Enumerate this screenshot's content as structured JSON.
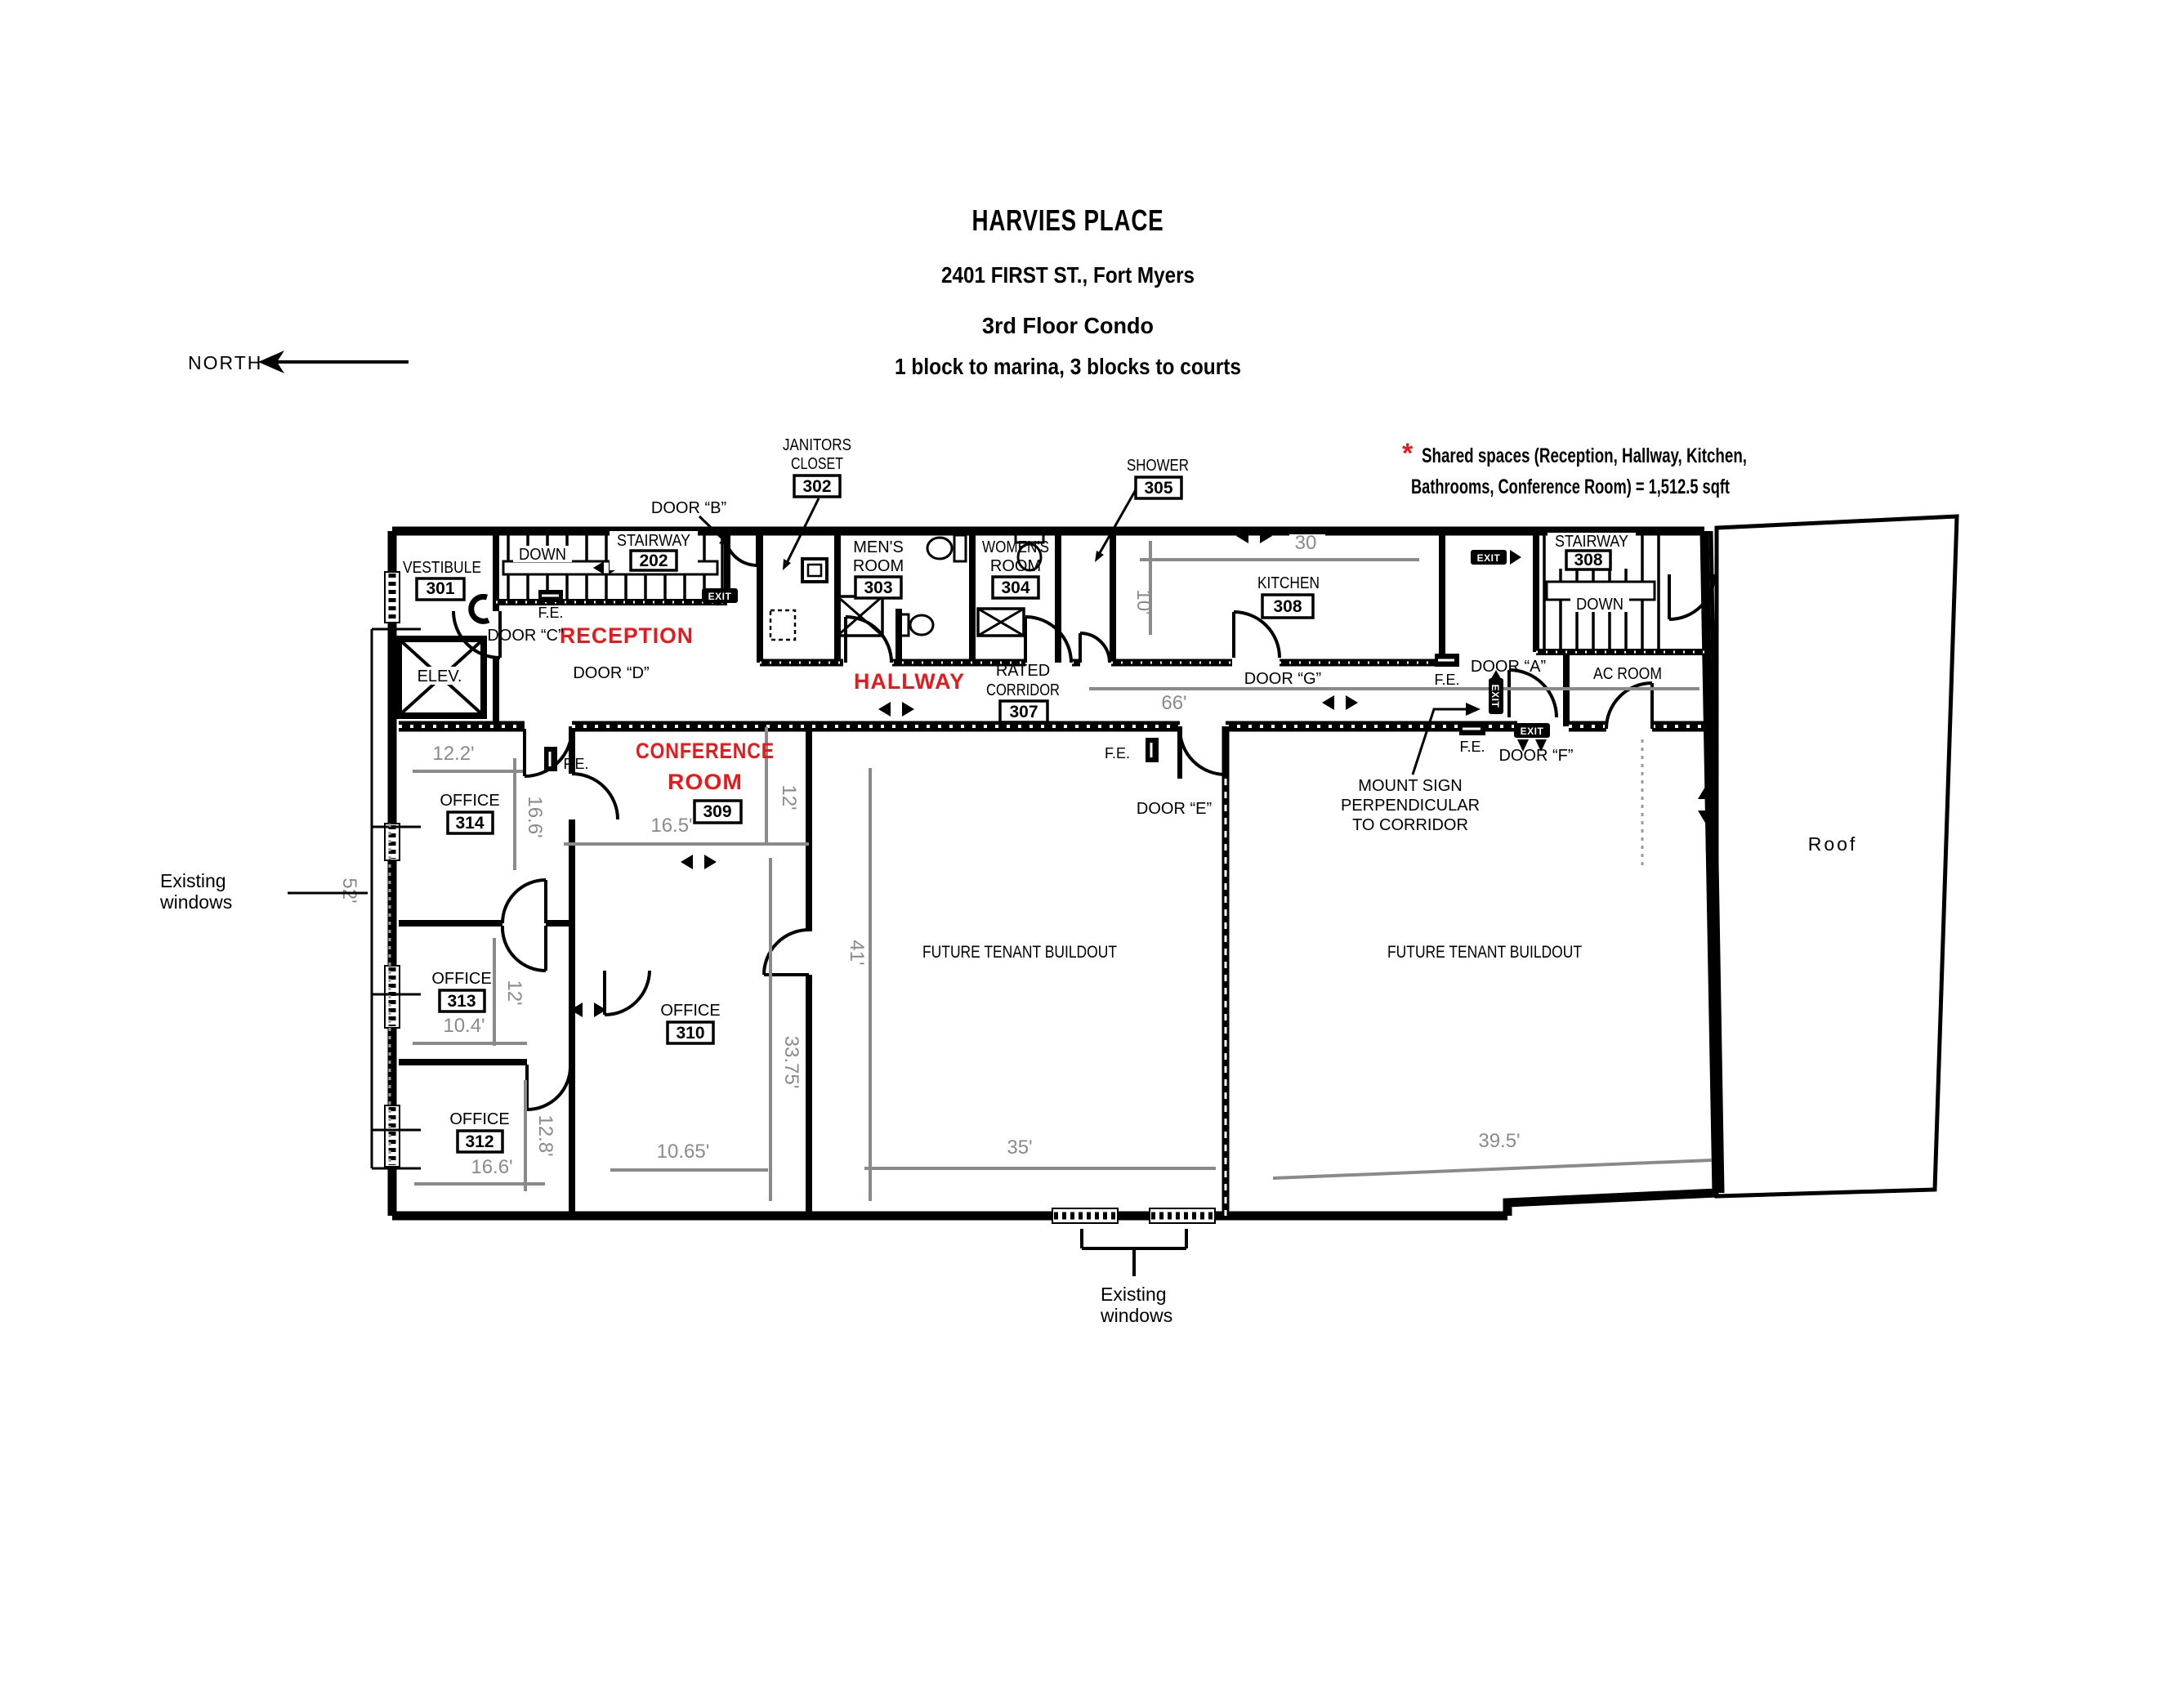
{
  "colors": {
    "accent_red": "#e8191c",
    "dim_gray": "#8a8a8a",
    "line_black": "#000000"
  },
  "header": {
    "title": "HARVIES PLACE",
    "address": "2401 FIRST ST., Fort Myers",
    "floor": "3rd Floor Condo",
    "distance": "1 block to marina, 3 blocks to courts"
  },
  "compass": {
    "label": "NORTH"
  },
  "note": {
    "star": "*",
    "line1": "Shared spaces (Reception, Hallway, Kitchen,",
    "line2": "Bathrooms, Conference Room) = 1,512.5 sqft"
  },
  "zones": {
    "reception": "RECEPTION",
    "hallway": "HALLWAY",
    "conference_line1": "CONFERENCE",
    "conference_line2": "ROOM",
    "conference_number": "309",
    "future_tenant": "FUTURE TENANT BUILDOUT",
    "ac_room": "AC ROOM",
    "roof": "Roof",
    "elevator": "ELEV."
  },
  "rooms": {
    "vestibule": {
      "name": "VESTIBULE",
      "number": "301"
    },
    "janitors_closet": {
      "name_line1": "JANITORS",
      "name_line2": "CLOSET",
      "number": "302"
    },
    "mens_room": {
      "name_line1": "MEN'S",
      "name_line2": "ROOM",
      "number": "303"
    },
    "womens_room": {
      "name_line1": "WOMEN'S",
      "name_line2": "ROOM",
      "number": "304"
    },
    "shower": {
      "name": "SHOWER",
      "number": "305"
    },
    "rated_corridor": {
      "name_line1": "RATED",
      "name_line2": "CORRIDOR",
      "number": "307"
    },
    "kitchen": {
      "name": "KITCHEN",
      "number": "308"
    },
    "stairway_202": {
      "name": "STAIRWAY",
      "number": "202"
    },
    "stairway_308": {
      "name": "STAIRWAY",
      "number": "308"
    },
    "office_310": {
      "name": "OFFICE",
      "number": "310"
    },
    "office_312": {
      "name": "OFFICE",
      "number": "312"
    },
    "office_313": {
      "name": "OFFICE",
      "number": "313"
    },
    "office_314": {
      "name": "OFFICE",
      "number": "314"
    }
  },
  "doors": {
    "a": "DOOR “A”",
    "b": "DOOR “B”",
    "c": "DOOR “C”",
    "d": "DOOR “D”",
    "e": "DOOR “E”",
    "f": "DOOR “F”",
    "g": "DOOR “G”"
  },
  "dimensions": {
    "kitchen_width": "30",
    "kitchen_depth": "10'",
    "corridor_length": "66'",
    "office_314_width": "12.2'",
    "office_314_depth": "16.6'",
    "office_313_depth": "12'",
    "office_313_width": "10.4'",
    "office_312_depth": "12.8'",
    "office_312_width": "16.6'",
    "conference_width": "16.5'",
    "conference_depth": "12'",
    "office_310_depth": "33.75'",
    "office_310_width": "10.65'",
    "buildout_west_depth": "41'",
    "buildout_west_width": "35'",
    "buildout_east_width": "39.5'",
    "west_wall_span": "52'"
  },
  "annotations": {
    "down": "DOWN",
    "fire_extinguisher": "F.E.",
    "exit": "EXIT",
    "mount_line1": "MOUNT SIGN",
    "mount_line2": "PERPENDICULAR",
    "mount_line3": "TO CORRIDOR",
    "existing_windows_line1": "Existing",
    "existing_windows_line2": "windows"
  }
}
